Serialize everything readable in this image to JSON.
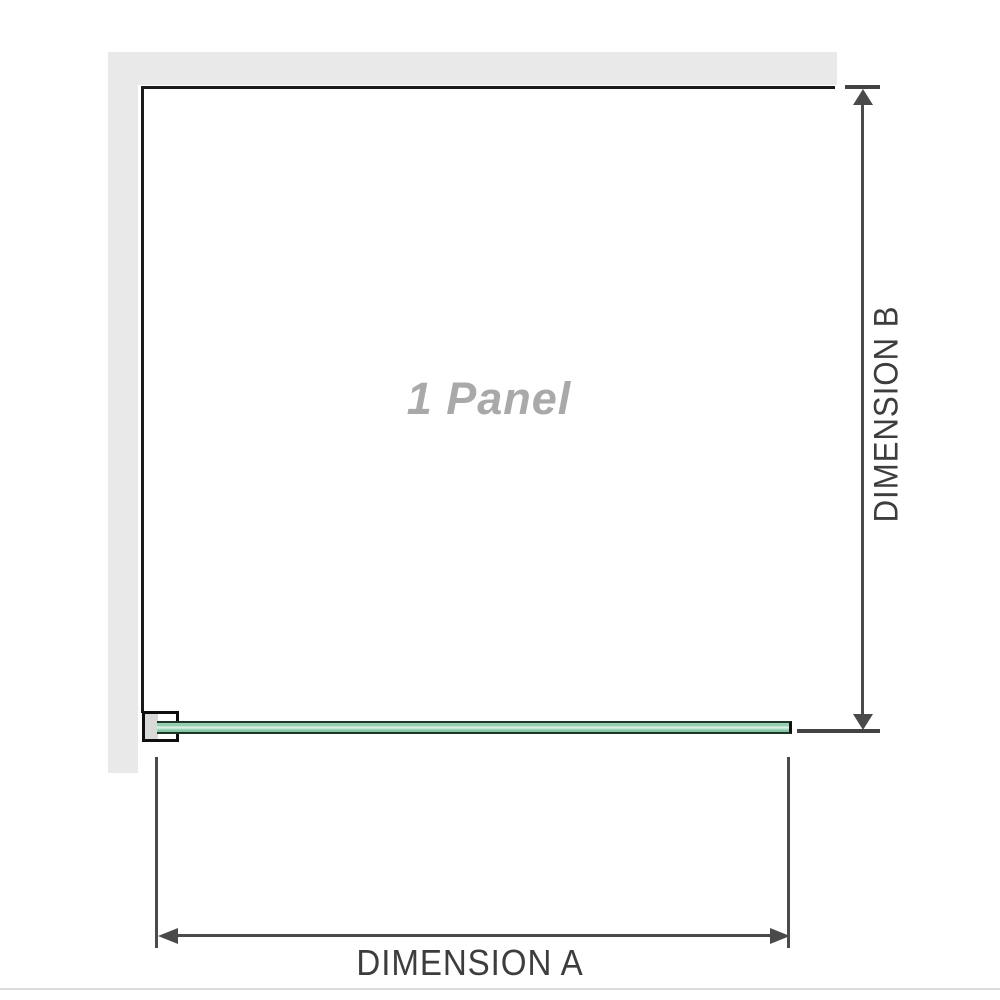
{
  "diagram": {
    "panel_label": "1 Panel",
    "dimension_a": {
      "label": "DIMENSION A"
    },
    "dimension_b": {
      "label": "DIMENSION B"
    }
  },
  "colors": {
    "wall_fill": "#e9e9e9",
    "wall_edge": "#1a1a1a",
    "dimension_line": "#4a4a4a",
    "dimension_text": "#3d3d3d",
    "panel_text": "#a9a9a9",
    "glass_green": "#8bcbaa",
    "glass_highlight": "#e0f1e8",
    "glass_edge": "#203529",
    "bracket_fill": "#d9d9d9",
    "footer_rule": "#dcdcdc"
  }
}
